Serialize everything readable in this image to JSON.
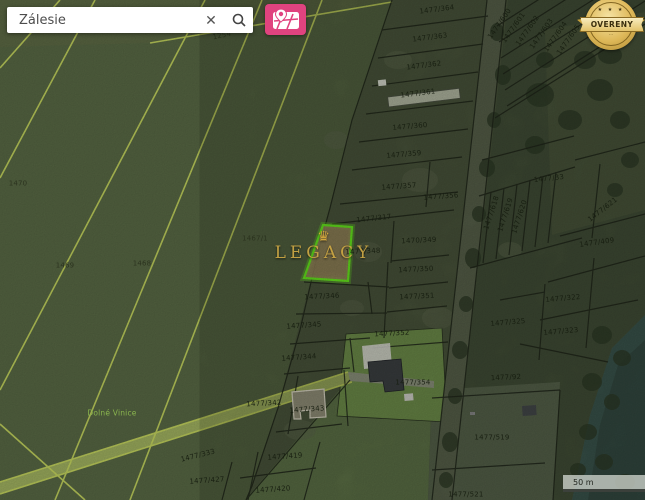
{
  "search": {
    "value": "Zálesie",
    "clear_icon": "✕"
  },
  "toolbar": {
    "map_button_icon": "map-with-pin"
  },
  "badge": {
    "stars": "★ ★ ★",
    "text": "OVERENY",
    "sub": "···"
  },
  "watermark": {
    "crown": "♛",
    "text": "LEGACY"
  },
  "scale": {
    "label": "50 m"
  },
  "colors": {
    "accent_pink": "#e0437f",
    "badge_gold": "#ddb757",
    "highlight_green": "#66e81e",
    "highlight_fill": "#97865a",
    "field_green": "#51603f",
    "boundary_yellow": "#b7c657",
    "water_teal": "#3a544c",
    "watermark_gold": "#c9a544"
  },
  "map": {
    "highlighted_parcel_label": "1477/348",
    "labels": [
      {
        "text": "1254",
        "x": 222,
        "y": 36,
        "rot": -12,
        "cls": "field"
      },
      {
        "text": "1470",
        "x": 18,
        "y": 184,
        "rot": 0,
        "cls": "field"
      },
      {
        "text": "1469",
        "x": 65,
        "y": 266,
        "rot": 0,
        "cls": "field"
      },
      {
        "text": "1468",
        "x": 142,
        "y": 264,
        "rot": 0,
        "cls": "field"
      },
      {
        "text": "1467/1",
        "x": 255,
        "y": 239,
        "rot": 0,
        "cls": "field"
      },
      {
        "text": "Dolné Vinice",
        "x": 112,
        "y": 413,
        "rot": 0,
        "cls": "place"
      },
      {
        "text": "1477/364",
        "x": 437,
        "y": 10,
        "rot": -7,
        "cls": "scrub"
      },
      {
        "text": "1477/363",
        "x": 430,
        "y": 38,
        "rot": -7,
        "cls": "scrub"
      },
      {
        "text": "1477/362",
        "x": 424,
        "y": 66,
        "rot": -7,
        "cls": "scrub"
      },
      {
        "text": "1477/361",
        "x": 418,
        "y": 94,
        "rot": -7,
        "cls": "scrub"
      },
      {
        "text": "1477/360",
        "x": 410,
        "y": 127,
        "rot": -5,
        "cls": "scrub"
      },
      {
        "text": "1477/359",
        "x": 404,
        "y": 155,
        "rot": -5,
        "cls": "scrub"
      },
      {
        "text": "1477/357",
        "x": 399,
        "y": 187,
        "rot": -4,
        "cls": "scrub"
      },
      {
        "text": "1477/356",
        "x": 441,
        "y": 197,
        "rot": -4,
        "cls": "scrub"
      },
      {
        "text": "1477/317",
        "x": 374,
        "y": 219,
        "rot": -6,
        "cls": "scrub"
      },
      {
        "text": "1477/348",
        "x": 363,
        "y": 252,
        "rot": -3,
        "cls": "scrub"
      },
      {
        "text": "1470/349",
        "x": 419,
        "y": 241,
        "rot": -3,
        "cls": "scrub"
      },
      {
        "text": "1477/350",
        "x": 416,
        "y": 270,
        "rot": -3,
        "cls": "scrub"
      },
      {
        "text": "1477/351",
        "x": 417,
        "y": 297,
        "rot": -3,
        "cls": "scrub"
      },
      {
        "text": "1477/346",
        "x": 322,
        "y": 297,
        "rot": -3,
        "cls": "scrub"
      },
      {
        "text": "1477/345",
        "x": 304,
        "y": 326,
        "rot": -4,
        "cls": "scrub"
      },
      {
        "text": "1477/352",
        "x": 392,
        "y": 334,
        "rot": -3,
        "cls": "scrub"
      },
      {
        "text": "1477/344",
        "x": 299,
        "y": 358,
        "rot": -4,
        "cls": "scrub"
      },
      {
        "text": "1477/354",
        "x": 413,
        "y": 383,
        "rot": 0,
        "cls": "scrub"
      },
      {
        "text": "1477/343",
        "x": 307,
        "y": 410,
        "rot": -4,
        "cls": "scrub"
      },
      {
        "text": "1477/342",
        "x": 264,
        "y": 404,
        "rot": -3,
        "cls": "scrub"
      },
      {
        "text": "1477/333",
        "x": 198,
        "y": 456,
        "rot": -14,
        "cls": "scrub"
      },
      {
        "text": "1477/427",
        "x": 207,
        "y": 481,
        "rot": -4,
        "cls": "scrub"
      },
      {
        "text": "1477/419",
        "x": 285,
        "y": 457,
        "rot": -4,
        "cls": "scrub"
      },
      {
        "text": "1477/420",
        "x": 273,
        "y": 490,
        "rot": -4,
        "cls": "scrub"
      },
      {
        "text": "1477/519",
        "x": 492,
        "y": 438,
        "rot": 0,
        "cls": "scrub"
      },
      {
        "text": "1477/521",
        "x": 466,
        "y": 495,
        "rot": 0,
        "cls": "scrub"
      },
      {
        "text": "1477/33",
        "x": 549,
        "y": 179,
        "rot": -6,
        "cls": "scrub"
      },
      {
        "text": "1477/618",
        "x": 492,
        "y": 213,
        "rot": -72,
        "cls": "scrub"
      },
      {
        "text": "1477/619",
        "x": 506,
        "y": 215,
        "rot": -72,
        "cls": "scrub"
      },
      {
        "text": "1477/620",
        "x": 520,
        "y": 217,
        "rot": -72,
        "cls": "scrub"
      },
      {
        "text": "1477/621",
        "x": 603,
        "y": 210,
        "rot": -38,
        "cls": "scrub"
      },
      {
        "text": "1477/409",
        "x": 597,
        "y": 243,
        "rot": -8,
        "cls": "scrub"
      },
      {
        "text": "1477/322",
        "x": 563,
        "y": 299,
        "rot": -5,
        "cls": "scrub"
      },
      {
        "text": "1477/323",
        "x": 561,
        "y": 332,
        "rot": -5,
        "cls": "scrub"
      },
      {
        "text": "1477/325",
        "x": 508,
        "y": 323,
        "rot": -5,
        "cls": "scrub"
      },
      {
        "text": "1477/92",
        "x": 506,
        "y": 378,
        "rot": -3,
        "cls": "scrub"
      },
      {
        "text": "1477/600",
        "x": 500,
        "y": 24,
        "rot": -55,
        "cls": "scrub"
      },
      {
        "text": "1477/601",
        "x": 514,
        "y": 28,
        "rot": -55,
        "cls": "scrub"
      },
      {
        "text": "1477/602",
        "x": 528,
        "y": 31,
        "rot": -55,
        "cls": "scrub"
      },
      {
        "text": "1477/603",
        "x": 542,
        "y": 34,
        "rot": -55,
        "cls": "scrub"
      },
      {
        "text": "1477/604",
        "x": 556,
        "y": 37,
        "rot": -55,
        "cls": "scrub"
      },
      {
        "text": "1477/605",
        "x": 569,
        "y": 40,
        "rot": -55,
        "cls": "scrub"
      }
    ]
  }
}
